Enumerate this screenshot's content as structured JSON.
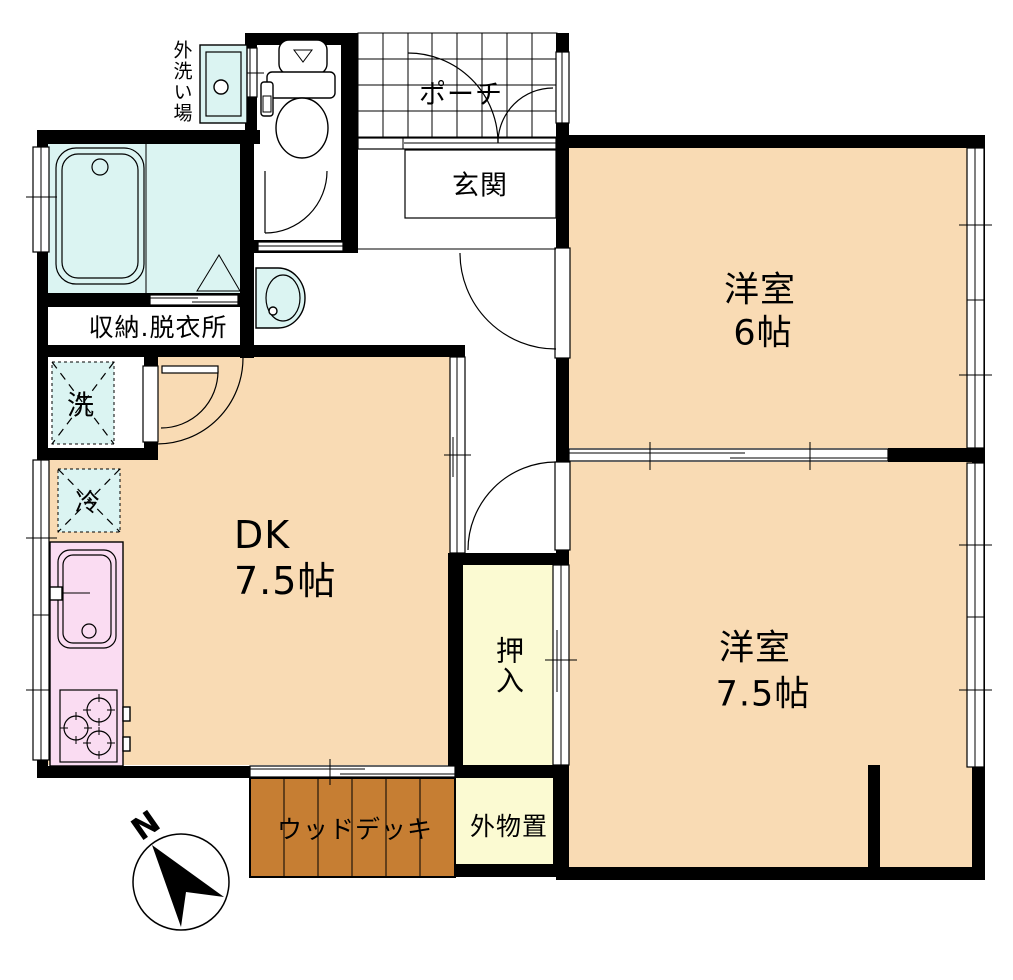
{
  "floorplan": {
    "compass": {
      "north_label": "N"
    },
    "colors": {
      "room": "#F9DBB4",
      "wet": "#DBF4F2",
      "closet": "#FBFAD2",
      "kitchen": "#FADCF2",
      "deck": "#C67E33",
      "wall": "#000000"
    },
    "rooms": {
      "porch": {
        "label": "ポーチ"
      },
      "entrance": {
        "label": "玄関"
      },
      "western_room_6": {
        "label": "洋室",
        "size": "6帖"
      },
      "storage_dressing": {
        "label": "収納.脱衣所"
      },
      "dk": {
        "label": "DK",
        "size": "7.5帖"
      },
      "closet": {
        "label": "押入"
      },
      "western_room_75": {
        "label": "洋室",
        "size": "7.5帖"
      },
      "wood_deck": {
        "label": "ウッドデッキ"
      },
      "outdoor_storage": {
        "label": "外物置"
      },
      "outdoor_wash_area": {
        "label": "外洗い場"
      }
    },
    "fixtures": {
      "washing_machine": {
        "label": "洗"
      },
      "refrigerator": {
        "label": "冷"
      }
    }
  }
}
